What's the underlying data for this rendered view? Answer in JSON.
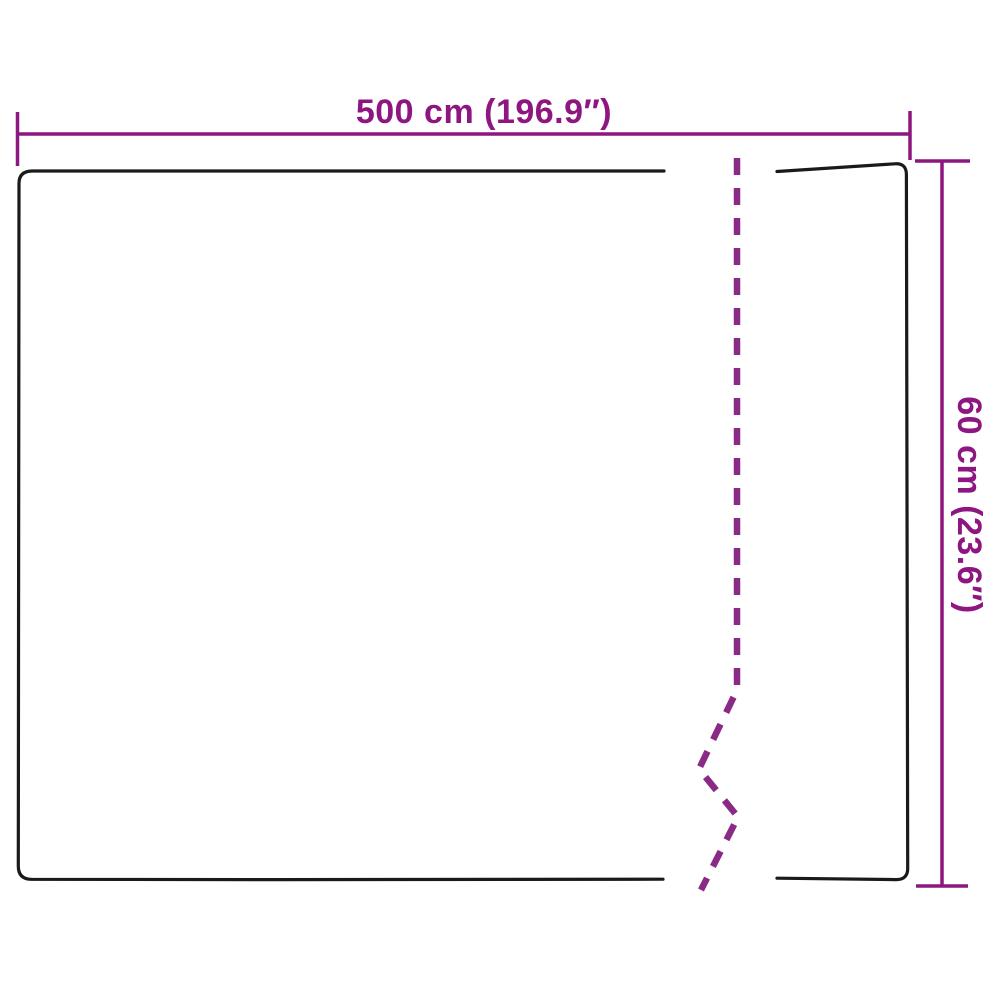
{
  "diagram": {
    "type": "product-dimension-sketch",
    "width_dimension": {
      "label": "500 cm (196.9″)",
      "value_cm": "500",
      "value_inch": "196.9"
    },
    "height_dimension": {
      "label": "60 cm (23.6″)",
      "value_cm": "60",
      "value_inch": "23.6"
    },
    "colors": {
      "annotation": "#8E1680",
      "cut_line": "#8A2A87",
      "outline": "#1A1A1A",
      "background": "#FFFFFF"
    }
  }
}
